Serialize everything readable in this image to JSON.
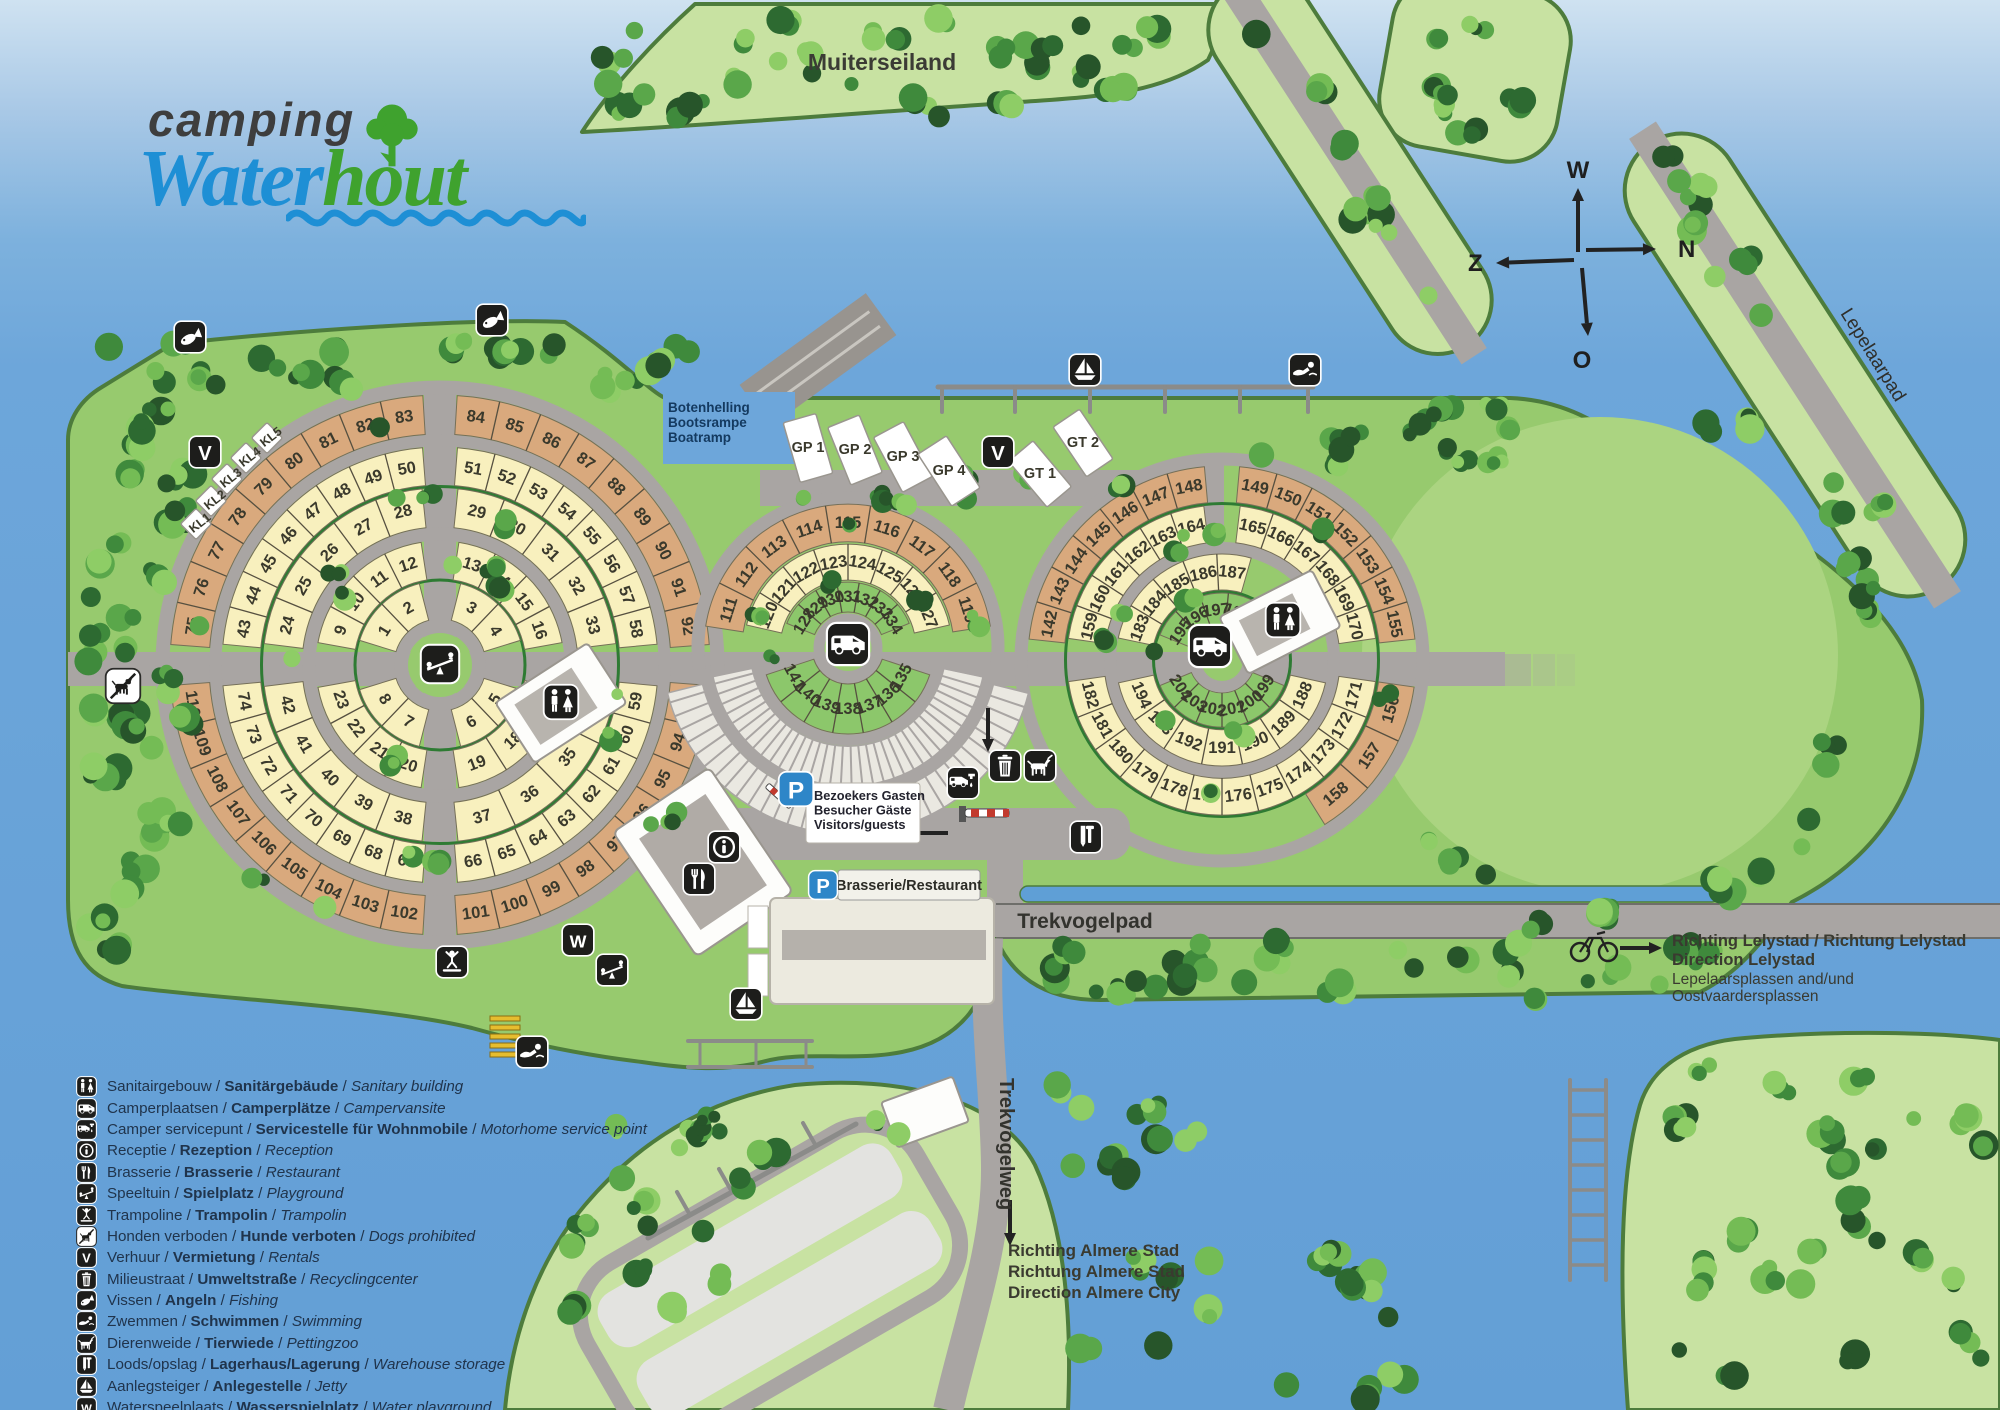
{
  "logo": {
    "line1": "camping",
    "word_blue": "Water",
    "word_green": "hout"
  },
  "island_label": "Muiterseiland",
  "compass": {
    "up": "W",
    "right": "N",
    "left": "Z",
    "down": "O"
  },
  "roads": {
    "lepelaarpad": "Lepelaarpad",
    "trekvogelpad": "Trekvogelpad",
    "trekvogelweg": "Trekvogelweg"
  },
  "boatramp_lines": [
    "Botenhelling",
    "Bootsrampe",
    "Boatramp"
  ],
  "visitor_parking_lines": [
    "Bezoekers Gasten",
    "Besucher Gäste",
    "Visitors/guests"
  ],
  "brasserie_label": "Brasserie/Restaurant",
  "directions": {
    "lelystad_bold": [
      "Richting Lelystad / Richtung Lelystad",
      "Direction Lelystad"
    ],
    "lelystad_regular": [
      "Lepelaarsplassen and/und",
      "Oostvaardersplassen"
    ],
    "almere_bold": [
      "Richting Almere Stad",
      "Richtung Almere Stad",
      "Direction Almere City"
    ]
  },
  "special_pitches": {
    "kl": [
      "KL1",
      "KL2",
      "KL3",
      "KL4",
      "KL5"
    ],
    "gp": [
      "GP 1",
      "GP 2",
      "GP 3",
      "GP 4"
    ],
    "gt": [
      "GT 1",
      "GT 2"
    ]
  },
  "circles": {
    "west": {
      "bands": [
        {
          "color": "yellow",
          "half": "top",
          "numbers": [
            [
              1,
              2
            ],
            [
              3,
              4
            ]
          ]
        },
        {
          "color": "yellow",
          "half": "bottom",
          "numbers": [
            [
              5,
              6
            ],
            [
              7,
              8
            ]
          ]
        },
        {
          "color": "yellow",
          "half": "top",
          "numbers": [
            [
              9,
              10,
              11,
              12
            ],
            [
              13,
              14,
              15,
              16
            ]
          ]
        },
        {
          "color": "yellow",
          "half": "bottom",
          "numbers": [
            [
              17,
              18,
              19
            ],
            [
              20,
              21,
              22,
              23
            ]
          ]
        },
        {
          "color": "yellow",
          "half": "top",
          "numbers": [
            [
              24,
              25,
              26,
              27,
              28
            ],
            [
              29,
              30,
              31,
              32,
              33
            ]
          ]
        },
        {
          "color": "yellow",
          "half": "bottom",
          "numbers": [
            [
              34,
              35,
              36,
              37
            ],
            [
              38,
              39,
              40,
              41,
              42
            ]
          ]
        },
        {
          "color": "yellow",
          "half": "top",
          "numbers": [
            [
              43,
              44,
              45,
              46,
              47,
              48,
              49,
              50
            ],
            [
              51,
              52,
              53,
              54,
              55,
              56,
              57,
              58
            ]
          ]
        },
        {
          "color": "yellow",
          "half": "bottom",
          "numbers": [
            [
              59,
              60,
              61,
              62,
              63,
              64,
              65,
              66
            ],
            [
              67,
              68,
              69,
              70,
              71,
              72,
              73,
              74
            ]
          ]
        },
        {
          "color": "tan",
          "half": "top",
          "numbers": [
            [
              75,
              76,
              77,
              78,
              79,
              80,
              81,
              82,
              83
            ],
            [
              84,
              85,
              86,
              87,
              88,
              89,
              90,
              91,
              92
            ]
          ]
        },
        {
          "color": "tan",
          "half": "bottom",
          "numbers": [
            [
              93,
              94,
              95,
              96,
              97,
              98,
              99,
              100,
              101
            ],
            [
              102,
              103,
              104,
              105,
              106,
              107,
              108,
              109,
              110
            ]
          ]
        }
      ]
    },
    "middle": {
      "bands": [
        {
          "color": "tan",
          "half": "top",
          "numbers": [
            [
              111,
              112,
              113,
              114,
              115,
              116,
              117,
              118,
              119
            ]
          ]
        },
        {
          "color": "yellow",
          "half": "top",
          "numbers": [
            [
              120,
              121,
              122,
              123,
              124,
              125,
              126,
              127
            ]
          ]
        },
        {
          "color": "green",
          "half": "top",
          "numbers": [
            [
              128,
              129,
              130,
              131,
              132,
              133,
              134
            ]
          ]
        },
        {
          "color": "green",
          "half": "bottom",
          "numbers": [
            [
              135,
              136,
              137,
              138,
              139,
              140,
              141
            ]
          ]
        }
      ]
    },
    "east": {
      "bands": [
        {
          "color": "tan",
          "half": "top",
          "numbers": [
            [
              142,
              143,
              144,
              145,
              146,
              147,
              148
            ],
            [
              149,
              150,
              151,
              152,
              153,
              154,
              155
            ]
          ]
        },
        {
          "color": "tan",
          "half": "bottom",
          "numbers": [
            [
              156,
              157,
              158
            ]
          ]
        },
        {
          "color": "yellow",
          "half": "top",
          "numbers": [
            [
              159,
              160,
              161,
              162,
              163,
              164
            ],
            [
              165,
              166,
              167,
              168,
              169,
              170
            ]
          ]
        },
        {
          "color": "yellow",
          "half": "bottom",
          "numbers": [
            [
              171,
              172,
              173,
              174,
              175,
              176,
              177,
              178,
              179,
              180,
              181,
              182
            ]
          ]
        },
        {
          "color": "yellow",
          "half": "top",
          "numbers": [
            [
              183,
              184,
              185,
              186,
              187
            ]
          ]
        },
        {
          "color": "yellow",
          "half": "bottom",
          "numbers": [
            [
              188,
              189,
              190,
              191,
              192,
              193,
              194
            ]
          ]
        },
        {
          "color": "green",
          "half": "top",
          "numbers": [
            [
              195,
              196,
              197,
              198
            ]
          ]
        },
        {
          "color": "green",
          "half": "bottom",
          "numbers": [
            [
              199,
              200,
              201,
              202,
              203,
              204
            ]
          ]
        }
      ]
    }
  },
  "map_icons": [
    {
      "id": "fishing-1",
      "icon": "fishing-icon"
    },
    {
      "id": "fishing-2",
      "icon": "fishing-icon"
    },
    {
      "id": "rentals-1",
      "icon": "rentals-v-icon"
    },
    {
      "id": "rentals-2",
      "icon": "rentals-v-icon"
    },
    {
      "id": "dogs-prohibited-1",
      "icon": "dogs-prohibited-icon"
    },
    {
      "id": "playground-1",
      "icon": "playground-icon"
    },
    {
      "id": "playground-2",
      "icon": "playground-icon"
    },
    {
      "id": "trampoline-1",
      "icon": "trampoline-icon"
    },
    {
      "id": "water-playground-1",
      "icon": "water-playground-icon"
    },
    {
      "id": "swimming-1",
      "icon": "swimming-icon"
    },
    {
      "id": "swimming-2",
      "icon": "swimming-icon"
    },
    {
      "id": "jetty-1",
      "icon": "sailboat-icon"
    },
    {
      "id": "jetty-2",
      "icon": "sailboat-icon"
    },
    {
      "id": "reception-1",
      "icon": "reception-icon"
    },
    {
      "id": "brasserie-1",
      "icon": "dining-icon"
    },
    {
      "id": "sanitary-west",
      "icon": "restroom-icon"
    },
    {
      "id": "sanitary-east",
      "icon": "restroom-icon"
    },
    {
      "id": "camper-middle",
      "icon": "camper-icon"
    },
    {
      "id": "camper-east",
      "icon": "camper-icon"
    },
    {
      "id": "camper-service-1",
      "icon": "camper-service-icon"
    },
    {
      "id": "recycling-1",
      "icon": "trash-icon"
    },
    {
      "id": "petting-zoo-1",
      "icon": "goat-icon"
    },
    {
      "id": "warehouse-1",
      "icon": "saw-icon"
    },
    {
      "id": "visitors-parking",
      "icon": "parking-p-icon"
    },
    {
      "id": "brasserie-parking",
      "icon": "parking-p-icon"
    }
  ],
  "legend": [
    {
      "icon": "restroom-icon",
      "nl": "Sanitairgebouw",
      "de": "Sanitärgebäude",
      "en": "Sanitary building"
    },
    {
      "icon": "camper-icon",
      "nl": "Camperplaatsen",
      "de": "Camperplätze",
      "en": "Campervansite"
    },
    {
      "icon": "camper-service-icon",
      "nl": "Camper servicepunt",
      "de": "Servicestelle für Wohnmobile",
      "en": "Motorhome service point"
    },
    {
      "icon": "reception-icon",
      "nl": "Receptie",
      "de": "Rezeption",
      "en": "Reception"
    },
    {
      "icon": "dining-icon",
      "nl": "Brasserie",
      "de": "Brasserie",
      "en": "Restaurant"
    },
    {
      "icon": "playground-icon",
      "nl": "Speeltuin",
      "de": "Spielplatz",
      "en": "Playground"
    },
    {
      "icon": "trampoline-icon",
      "nl": "Trampoline",
      "de": "Trampolin",
      "en": "Trampolin"
    },
    {
      "icon": "dogs-prohibited-icon",
      "nl": "Honden verboden",
      "de": "Hunde verboten",
      "en": "Dogs prohibited"
    },
    {
      "icon": "rentals-v-icon",
      "nl": "Verhuur",
      "de": "Vermietung",
      "en": "Rentals"
    },
    {
      "icon": "trash-icon",
      "nl": "Milieustraat",
      "de": "Umweltstraße",
      "en": "Recyclingcenter"
    },
    {
      "icon": "fishing-icon",
      "nl": "Vissen",
      "de": "Angeln",
      "en": "Fishing"
    },
    {
      "icon": "swimming-icon",
      "nl": "Zwemmen",
      "de": "Schwimmen",
      "en": "Swimming"
    },
    {
      "icon": "goat-icon",
      "nl": "Dierenweide",
      "de": "Tierwiede",
      "en": "Pettingzoo"
    },
    {
      "icon": "saw-icon",
      "nl": "Loods/opslag",
      "de": "Lagerhaus/Lagerung",
      "en": "Warehouse storage"
    },
    {
      "icon": "sailboat-icon",
      "nl": "Aanlegsteiger",
      "de": "Anlegestelle",
      "en": "Jetty"
    },
    {
      "icon": "water-playground-icon",
      "nl": "Waterspeelplaats",
      "de": "Wasserspielplatz",
      "en": "Water playground"
    }
  ],
  "colors": {
    "water": "#6da6da",
    "land": "#97ca6e",
    "island": "#c8e2a2",
    "field": "#abd481",
    "road": "#a9a5a3",
    "pitch_yellow": "#f8f0be",
    "pitch_tan": "#d9a97d",
    "pitch_green": "#8cc76b",
    "hedge": "#2e7b33",
    "icon_bg": "#1d1d1b",
    "accent_blue": "#2e86c8",
    "text_dark": "#3a392c",
    "legend_text": "#20344c",
    "logo_blue": "#1e8fd5",
    "logo_green": "#3fa22e"
  }
}
